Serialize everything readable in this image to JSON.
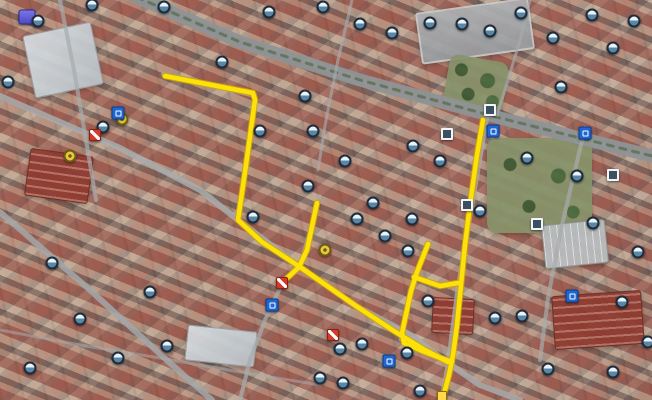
{
  "map": {
    "width": 652,
    "height": 400,
    "colors": {
      "route_fill": "#ffe10a",
      "route_outline": "#c9a50a",
      "road_gray": "#9b9fa1",
      "boulevard_gray": "#8e9496",
      "tree_median_green": "#5d6e52"
    },
    "routes": [
      {
        "id": "west-loop",
        "points": [
          [
            165,
            76
          ],
          [
            253,
            93
          ],
          [
            255,
            100
          ],
          [
            246,
            165
          ],
          [
            238,
            220
          ],
          [
            262,
            242
          ],
          [
            300,
            267
          ],
          [
            356,
            306
          ],
          [
            394,
            331
          ],
          [
            425,
            350
          ],
          [
            448,
            362
          ]
        ]
      },
      {
        "id": "east-vertical",
        "points": [
          [
            483,
            120
          ],
          [
            477,
            155
          ],
          [
            470,
            205
          ],
          [
            465,
            245
          ],
          [
            461,
            285
          ],
          [
            457,
            325
          ],
          [
            453,
            355
          ],
          [
            449,
            375
          ],
          [
            444,
            394
          ]
        ]
      },
      {
        "id": "center-spur",
        "points": [
          [
            317,
            203
          ],
          [
            307,
            250
          ],
          [
            299,
            267
          ],
          [
            283,
            282
          ]
        ]
      },
      {
        "id": "inner-l-branch",
        "points": [
          [
            428,
            244
          ],
          [
            417,
            272
          ],
          [
            411,
            291
          ],
          [
            402,
            333
          ],
          [
            404,
            343
          ],
          [
            420,
            350
          ],
          [
            438,
            357
          ],
          [
            452,
            362
          ]
        ]
      },
      {
        "id": "cross-connector",
        "points": [
          [
            414,
            277
          ],
          [
            440,
            286
          ],
          [
            458,
            283
          ]
        ]
      }
    ],
    "roads": [
      {
        "id": "boulevard",
        "points": [
          [
            125,
            -8
          ],
          [
            240,
            42
          ],
          [
            360,
            80
          ],
          [
            500,
            118
          ],
          [
            660,
            158
          ]
        ],
        "width": 13,
        "color": "#8e9496",
        "opacity": 0.95
      },
      {
        "id": "boulevard-median",
        "points": [
          [
            125,
            -8
          ],
          [
            240,
            42
          ],
          [
            360,
            80
          ],
          [
            500,
            118
          ],
          [
            660,
            158
          ]
        ],
        "width": 3,
        "color": "#5d6e52",
        "dash": "6 7",
        "opacity": 0.8
      },
      {
        "id": "southwest-diagonal",
        "points": [
          [
            0,
            96
          ],
          [
            120,
            148
          ],
          [
            200,
            190
          ],
          [
            238,
            220
          ],
          [
            300,
            267
          ],
          [
            356,
            306
          ],
          [
            407,
            333
          ],
          [
            448,
            363
          ],
          [
            480,
            385
          ],
          [
            520,
            400
          ]
        ],
        "width": 6,
        "color": "#a8abad",
        "opacity": 0.85
      },
      {
        "id": "east-street",
        "points": [
          [
            487,
            116
          ],
          [
            470,
            215
          ],
          [
            458,
            290
          ],
          [
            448,
            365
          ],
          [
            442,
            400
          ]
        ],
        "width": 5,
        "color": "#a8abad",
        "opacity": 0.8
      },
      {
        "id": "west-street",
        "points": [
          [
            163,
            74
          ],
          [
            255,
            96
          ],
          [
            247,
            160
          ],
          [
            237,
            218
          ]
        ],
        "width": 4,
        "color": "#a8abad",
        "opacity": 0.75
      },
      {
        "id": "center-street",
        "points": [
          [
            319,
            198
          ],
          [
            300,
            267
          ],
          [
            282,
            284
          ],
          [
            265,
            320
          ],
          [
            250,
            360
          ],
          [
            240,
            400
          ]
        ],
        "width": 4,
        "color": "#a8abad",
        "opacity": 0.75
      },
      {
        "id": "inner-street",
        "points": [
          [
            428,
            240
          ],
          [
            412,
            292
          ],
          [
            400,
            340
          ]
        ],
        "width": 3,
        "color": "#a8abad",
        "opacity": 0.7
      },
      {
        "id": "lower-left-diagonal",
        "points": [
          [
            0,
            212
          ],
          [
            90,
            290
          ],
          [
            170,
            363
          ],
          [
            212,
            400
          ]
        ],
        "width": 6,
        "color": "#a3a7a9",
        "opacity": 0.85
      },
      {
        "id": "left-vertical",
        "points": [
          [
            60,
            0
          ],
          [
            74,
            70
          ],
          [
            86,
            140
          ],
          [
            96,
            200
          ]
        ],
        "width": 4,
        "color": "#a8abad",
        "opacity": 0.7
      },
      {
        "id": "right-vertical",
        "points": [
          [
            585,
            128
          ],
          [
            562,
            225
          ],
          [
            548,
            298
          ],
          [
            540,
            360
          ]
        ],
        "width": 4,
        "color": "#a8abad",
        "opacity": 0.7
      },
      {
        "id": "upper-mid-vertical",
        "points": [
          [
            352,
            0
          ],
          [
            338,
            60
          ],
          [
            326,
            120
          ],
          [
            318,
            170
          ]
        ],
        "width": 3,
        "color": "#a8abad",
        "opacity": 0.65
      },
      {
        "id": "upper-right-vertical",
        "points": [
          [
            530,
            0
          ],
          [
            520,
            40
          ],
          [
            508,
            80
          ],
          [
            497,
            115
          ]
        ],
        "width": 3,
        "color": "#a8abad",
        "opacity": 0.65
      },
      {
        "id": "bottom-cross",
        "points": [
          [
            0,
            330
          ],
          [
            80,
            345
          ],
          [
            160,
            358
          ],
          [
            240,
            372
          ],
          [
            320,
            385
          ]
        ],
        "width": 3,
        "color": "#a8abad",
        "opacity": 0.55
      }
    ],
    "landmarks": [
      {
        "type": "school-block",
        "x": 418,
        "y": 5,
        "w": 110,
        "h": 48,
        "rot": -8
      },
      {
        "type": "white-building",
        "x": 28,
        "y": 28,
        "w": 68,
        "h": 62,
        "rot": -12
      },
      {
        "type": "park",
        "x": 487,
        "y": 138,
        "w": 105,
        "h": 95,
        "rot": 0
      },
      {
        "type": "park",
        "x": 446,
        "y": 58,
        "w": 60,
        "h": 52,
        "rot": 10
      },
      {
        "type": "parking-lot",
        "x": 543,
        "y": 222,
        "w": 62,
        "h": 42,
        "rot": -6
      },
      {
        "type": "red-roof-building",
        "x": 553,
        "y": 293,
        "w": 88,
        "h": 52,
        "rot": -4
      },
      {
        "type": "red-roof-building",
        "x": 27,
        "y": 152,
        "w": 62,
        "h": 46,
        "rot": 8
      },
      {
        "type": "red-roof-building",
        "x": 432,
        "y": 298,
        "w": 40,
        "h": 34,
        "rot": 3
      },
      {
        "type": "white-building",
        "x": 186,
        "y": 328,
        "w": 68,
        "h": 34,
        "rot": 6
      }
    ],
    "icons": [
      {
        "type": "poi-purple",
        "x": 27,
        "y": 17
      },
      {
        "type": "photo-circle",
        "x": 38,
        "y": 21
      },
      {
        "type": "photo-circle",
        "x": 92,
        "y": 5
      },
      {
        "type": "photo-circle",
        "x": 164,
        "y": 7
      },
      {
        "type": "photo-circle",
        "x": 269,
        "y": 12
      },
      {
        "type": "photo-circle",
        "x": 323,
        "y": 7
      },
      {
        "type": "photo-circle",
        "x": 360,
        "y": 24
      },
      {
        "type": "photo-circle",
        "x": 392,
        "y": 33
      },
      {
        "type": "photo-circle",
        "x": 430,
        "y": 23
      },
      {
        "type": "photo-circle",
        "x": 462,
        "y": 24
      },
      {
        "type": "photo-circle",
        "x": 490,
        "y": 31
      },
      {
        "type": "photo-circle",
        "x": 521,
        "y": 13
      },
      {
        "type": "photo-circle",
        "x": 553,
        "y": 38
      },
      {
        "type": "photo-circle",
        "x": 592,
        "y": 15
      },
      {
        "type": "photo-circle",
        "x": 634,
        "y": 21
      },
      {
        "type": "photo-circle",
        "x": 613,
        "y": 48
      },
      {
        "type": "photo-circle",
        "x": 561,
        "y": 87
      },
      {
        "type": "photo-circle",
        "x": 8,
        "y": 82
      },
      {
        "type": "photo-circle",
        "x": 103,
        "y": 127
      },
      {
        "type": "yellow-circle",
        "x": 122,
        "y": 119
      },
      {
        "type": "red-marker",
        "x": 95,
        "y": 135
      },
      {
        "type": "transit-blue",
        "x": 118,
        "y": 113
      },
      {
        "type": "yellow-circle",
        "x": 70,
        "y": 156
      },
      {
        "type": "photo-circle",
        "x": 222,
        "y": 62
      },
      {
        "type": "photo-circle",
        "x": 260,
        "y": 131
      },
      {
        "type": "photo-circle",
        "x": 305,
        "y": 96
      },
      {
        "type": "photo-circle",
        "x": 313,
        "y": 131
      },
      {
        "type": "photo-circle",
        "x": 345,
        "y": 161
      },
      {
        "type": "photo-circle",
        "x": 308,
        "y": 186
      },
      {
        "type": "photo-circle",
        "x": 373,
        "y": 203
      },
      {
        "type": "photo-circle",
        "x": 413,
        "y": 146
      },
      {
        "type": "photo-circle",
        "x": 440,
        "y": 161
      },
      {
        "type": "square-photo",
        "x": 447,
        "y": 134
      },
      {
        "type": "square-photo",
        "x": 490,
        "y": 110
      },
      {
        "type": "transit-blue",
        "x": 493,
        "y": 131
      },
      {
        "type": "transit-blue",
        "x": 585,
        "y": 133
      },
      {
        "type": "square-photo",
        "x": 613,
        "y": 175
      },
      {
        "type": "photo-circle",
        "x": 577,
        "y": 176
      },
      {
        "type": "photo-circle",
        "x": 527,
        "y": 158
      },
      {
        "type": "photo-circle",
        "x": 480,
        "y": 211
      },
      {
        "type": "square-photo",
        "x": 467,
        "y": 205
      },
      {
        "type": "square-photo",
        "x": 537,
        "y": 224
      },
      {
        "type": "photo-circle",
        "x": 593,
        "y": 223
      },
      {
        "type": "photo-circle",
        "x": 638,
        "y": 252
      },
      {
        "type": "photo-circle",
        "x": 622,
        "y": 302
      },
      {
        "type": "photo-circle",
        "x": 648,
        "y": 342
      },
      {
        "type": "transit-blue",
        "x": 572,
        "y": 296
      },
      {
        "type": "photo-circle",
        "x": 253,
        "y": 217
      },
      {
        "type": "yellow-circle",
        "x": 325,
        "y": 250
      },
      {
        "type": "photo-circle",
        "x": 357,
        "y": 219
      },
      {
        "type": "photo-circle",
        "x": 385,
        "y": 236
      },
      {
        "type": "photo-circle",
        "x": 412,
        "y": 219
      },
      {
        "type": "photo-circle",
        "x": 408,
        "y": 251
      },
      {
        "type": "red-marker",
        "x": 282,
        "y": 283
      },
      {
        "type": "transit-blue",
        "x": 272,
        "y": 305
      },
      {
        "type": "red-marker",
        "x": 333,
        "y": 335
      },
      {
        "type": "photo-circle",
        "x": 340,
        "y": 349
      },
      {
        "type": "photo-circle",
        "x": 362,
        "y": 344
      },
      {
        "type": "transit-blue",
        "x": 389,
        "y": 361
      },
      {
        "type": "photo-circle",
        "x": 320,
        "y": 378
      },
      {
        "type": "photo-circle",
        "x": 343,
        "y": 383
      },
      {
        "type": "photo-circle",
        "x": 407,
        "y": 353
      },
      {
        "type": "photo-circle",
        "x": 420,
        "y": 391
      },
      {
        "type": "yellow-square",
        "x": 442,
        "y": 396
      },
      {
        "type": "photo-circle",
        "x": 428,
        "y": 301
      },
      {
        "type": "photo-circle",
        "x": 495,
        "y": 318
      },
      {
        "type": "photo-circle",
        "x": 522,
        "y": 316
      },
      {
        "type": "photo-circle",
        "x": 548,
        "y": 369
      },
      {
        "type": "photo-circle",
        "x": 613,
        "y": 372
      },
      {
        "type": "photo-circle",
        "x": 52,
        "y": 263
      },
      {
        "type": "photo-circle",
        "x": 80,
        "y": 319
      },
      {
        "type": "photo-circle",
        "x": 118,
        "y": 358
      },
      {
        "type": "photo-circle",
        "x": 150,
        "y": 292
      },
      {
        "type": "photo-circle",
        "x": 167,
        "y": 346
      },
      {
        "type": "photo-circle",
        "x": 30,
        "y": 368
      }
    ]
  }
}
